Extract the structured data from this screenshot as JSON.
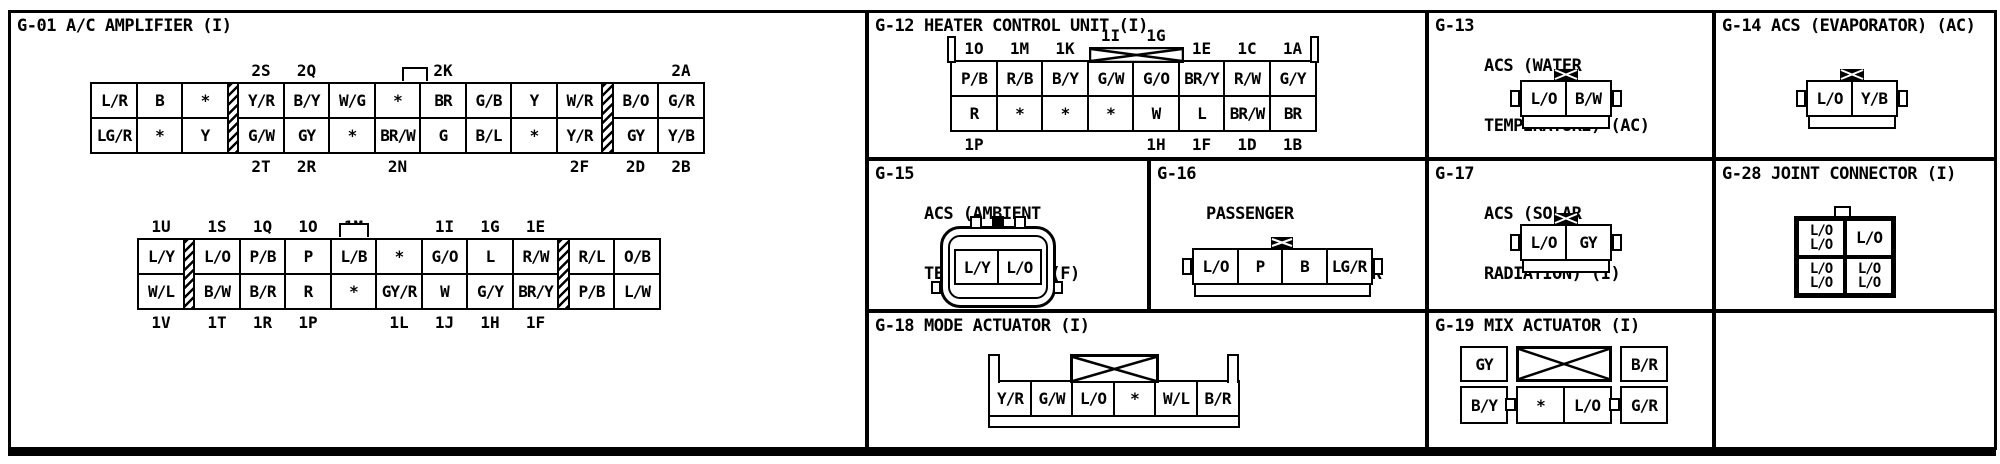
{
  "g01": {
    "code": "G-01",
    "name": [
      "A/C AMPLIFIER (I)"
    ],
    "conn_a": {
      "top_labels": [
        "",
        "",
        "",
        "2S",
        "2Q",
        "",
        "",
        "2K",
        "",
        "",
        "",
        "",
        "2A"
      ],
      "top_cells": [
        "L/R",
        "B",
        "*",
        "Y/R",
        "B/Y",
        "W/G",
        "*",
        "BR",
        "G/B",
        "Y",
        "W/R",
        "B/O",
        "G/R"
      ],
      "bottom_cells": [
        "LG/R",
        "*",
        "Y",
        "G/W",
        "GY",
        "*",
        "BR/W",
        "G",
        "B/L",
        "*",
        "Y/R",
        "GY",
        "Y/B"
      ],
      "bottom_labels": [
        "",
        "",
        "",
        "2T",
        "2R",
        "",
        "2N",
        "",
        "",
        "",
        "2F",
        "2D",
        "2B"
      ]
    },
    "conn_b": {
      "top_labels": [
        "1U",
        "1S",
        "1Q",
        "1O",
        "1M",
        "",
        "1I",
        "1G",
        "1E",
        "",
        ""
      ],
      "top_cells": [
        "L/Y",
        "L/O",
        "P/B",
        "P",
        "L/B",
        "*",
        "G/O",
        "L",
        "R/W",
        "R/L",
        "O/B"
      ],
      "bottom_cells": [
        "W/L",
        "B/W",
        "B/R",
        "R",
        "*",
        "GY/R",
        "W",
        "G/Y",
        "BR/Y",
        "P/B",
        "L/W"
      ],
      "bottom_labels": [
        "1V",
        "1T",
        "1R",
        "1P",
        "",
        "1L",
        "1J",
        "1H",
        "1F",
        "",
        ""
      ]
    }
  },
  "g12": {
    "code": "G-12",
    "name": [
      "HEATER CONTROL UNIT (I)"
    ],
    "top_labels": [
      "1O",
      "1M",
      "1K",
      "1I",
      "1G",
      "1E",
      "1C",
      "1A"
    ],
    "top_cells": [
      "P/B",
      "R/B",
      "B/Y",
      "G/W",
      "G/O",
      "BR/Y",
      "R/W",
      "G/Y"
    ],
    "bottom_cells": [
      "R",
      "*",
      "*",
      "*",
      "W",
      "L",
      "BR/W",
      "BR"
    ],
    "bottom_labels": [
      "1P",
      "",
      "",
      "",
      "1H",
      "1F",
      "1D",
      "1B"
    ]
  },
  "g13": {
    "code": "G-13",
    "name": [
      "ACS (WATER",
      "TEMPERATURE) (AC)"
    ],
    "pins": [
      "L/O",
      "B/W"
    ]
  },
  "g14": {
    "code": "G-14",
    "name": [
      "ACS (EVAPORATOR) (AC)"
    ],
    "pins": [
      "L/O",
      "Y/B"
    ]
  },
  "g15": {
    "code": "G-15",
    "name": [
      "ACS (AMBIENT",
      "TEMPERATURE) (F)"
    ],
    "pins": [
      "L/Y",
      "L/O"
    ]
  },
  "g16": {
    "code": "G-16",
    "name": [
      "PASSENGER",
      "COMPARTMENT SENSOR",
      "(I)"
    ],
    "pins": [
      "L/O",
      "P",
      "B",
      "LG/R"
    ]
  },
  "g17": {
    "code": "G-17",
    "name": [
      "ACS (SOLAR",
      "RADIATION) (I)"
    ],
    "pins": [
      "L/O",
      "GY"
    ]
  },
  "g28": {
    "code": "G-28",
    "name": [
      "JOINT CONNECTOR (I)"
    ],
    "cells": {
      "tl": [
        "L/O",
        "L/O"
      ],
      "tr": [
        "L/O"
      ],
      "bl": [
        "L/O",
        "L/O"
      ],
      "br": [
        "L/O",
        "L/O"
      ]
    }
  },
  "g18": {
    "code": "G-18",
    "name": [
      "MODE ACTUATOR (I)"
    ],
    "pins": [
      "Y/R",
      "G/W",
      "L/O",
      "*",
      "W/L",
      "B/R"
    ]
  },
  "g19": {
    "code": "G-19",
    "name": [
      "MIX ACTUATOR (I)"
    ],
    "top_left": "GY",
    "top_right": "B/R",
    "bottom": [
      "B/Y",
      "*",
      "L/O",
      "G/R"
    ]
  }
}
